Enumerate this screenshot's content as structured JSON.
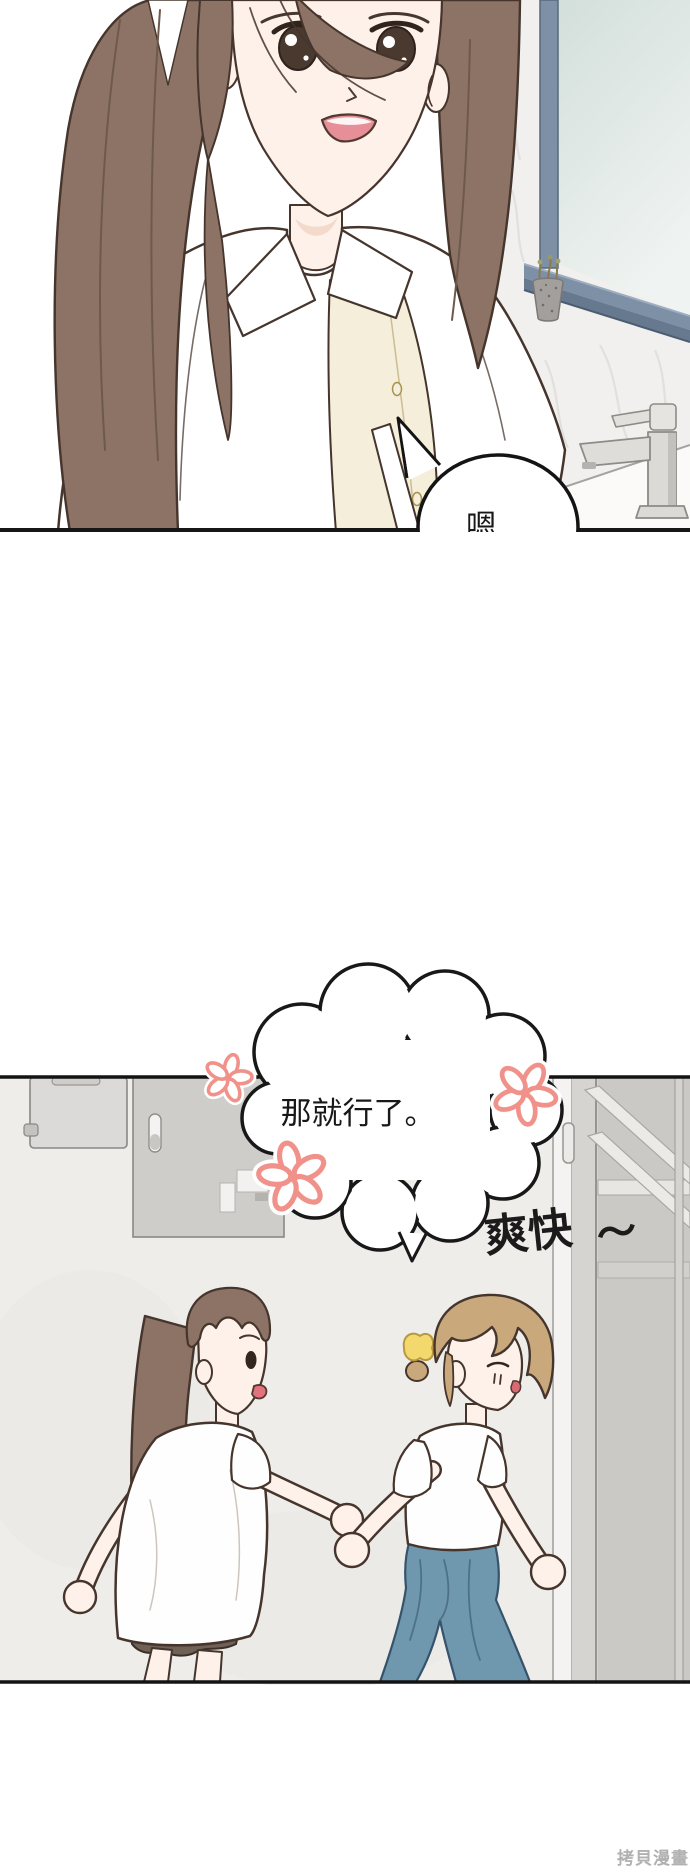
{
  "page": {
    "width": 690,
    "height": 1874,
    "background": "#ffffff",
    "watermark": "拷貝漫畫"
  },
  "panel_bathroom": {
    "speech_bubble_text": "嗯…"
  },
  "panel_hallway": {
    "cloud_bubble_text": "那就行了。",
    "sfx_text": "爽快",
    "sfx_tilde": "～",
    "flower_decoration_count": 3
  },
  "colors": {
    "ink_line": "#181818",
    "outline_dark": "#45352d",
    "hair_brown": "#8d7365",
    "hair_sandy": "#c9a97c",
    "hair_clip_yellow": "#f3d96d",
    "skin": "#fdf1ea",
    "cream_top": "#f4eeda",
    "jeans_blue": "#6f97ad",
    "shorts_brown": "#6f6156",
    "flower_pink": "#f0928a",
    "window_frame_blue": "#7d90a6",
    "window_glass": "#d3dfdb",
    "marble_wall": "#f1f0ee",
    "hall_wall": "#efedea",
    "door_gray": "#cbc9c6",
    "fusebox_gray": "#cfcdc9",
    "faucet_chrome": "#dcdad6",
    "watermark_gray": "#b1b1b1"
  }
}
